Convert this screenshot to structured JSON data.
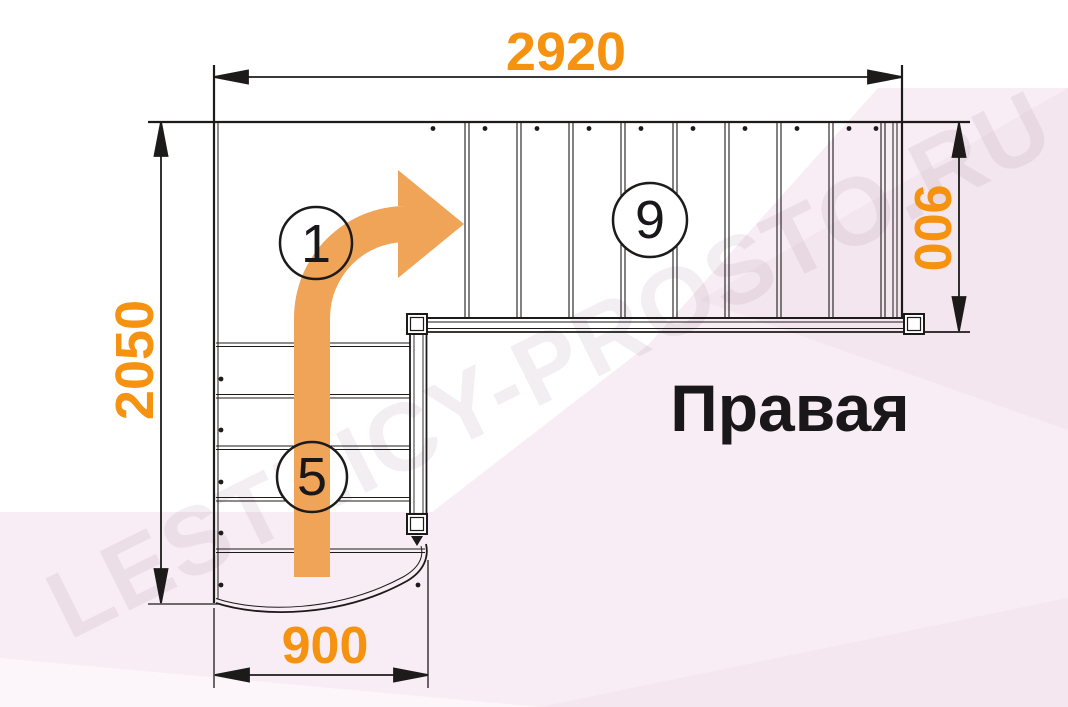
{
  "diagram": {
    "title": "Правая",
    "watermark": "LESTNICY-PROSTO.RU",
    "dimensions": {
      "total_length_top": "2920",
      "total_depth_left": "2050",
      "upper_flight_width_right": "900",
      "lower_flight_width_bottom": "900"
    },
    "step_labels": {
      "route_start": "1",
      "lower_flight_steps": "5",
      "upper_flight_steps": "9"
    },
    "colors": {
      "dimension_text": "#f5920f",
      "route_arrow": "#f0a457",
      "outline": "#1d1b1a",
      "background_tint": "#f8edf4"
    }
  }
}
